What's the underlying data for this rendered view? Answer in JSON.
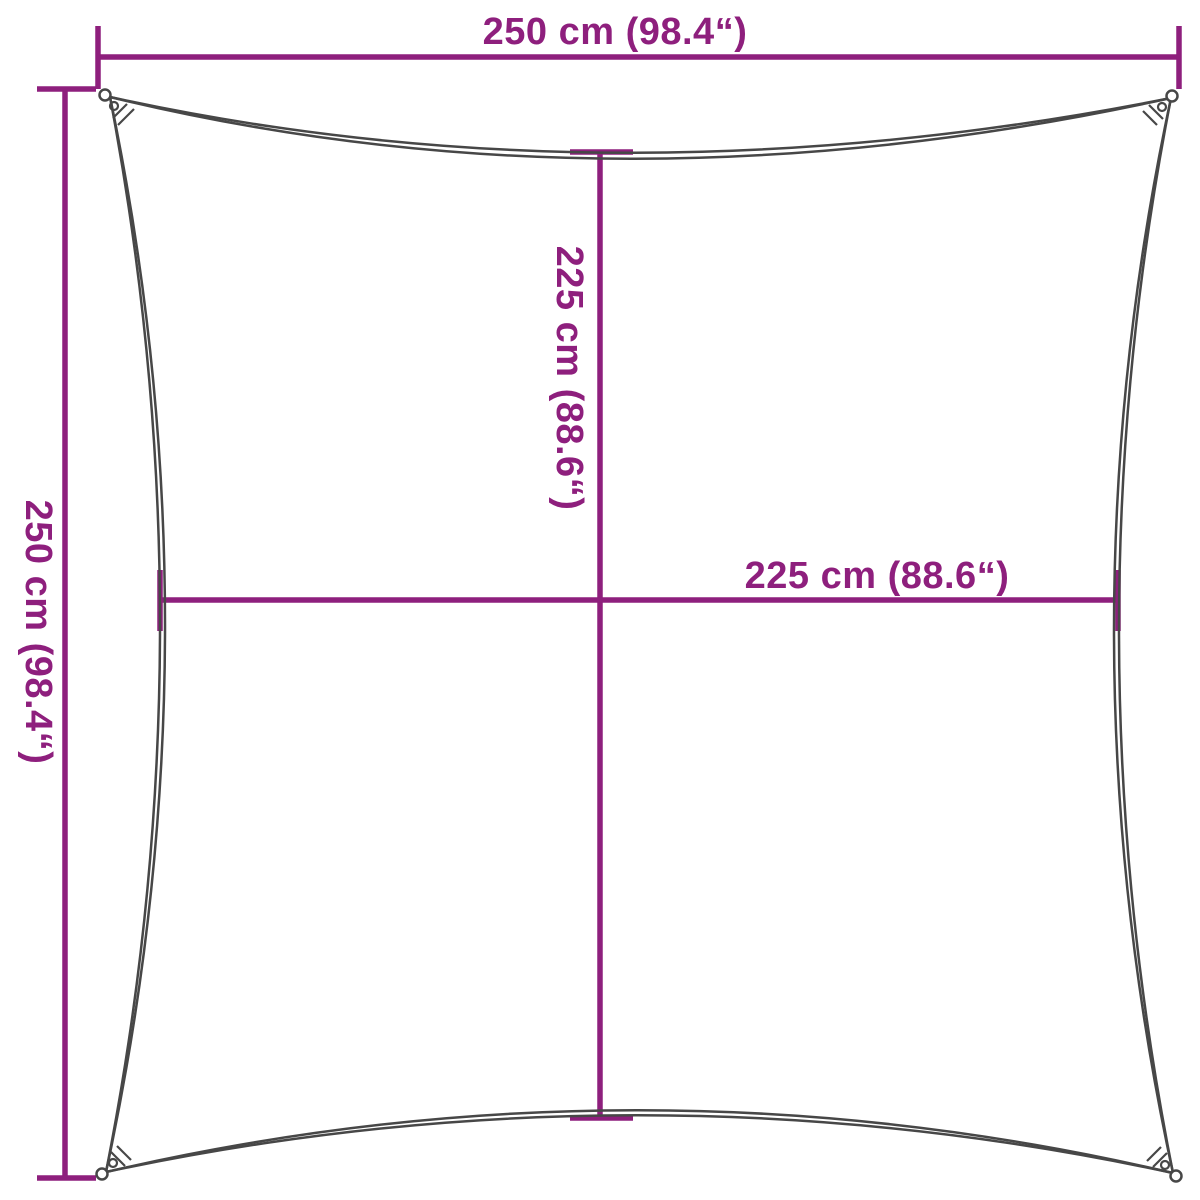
{
  "colors": {
    "dimension": "#8E1F7D",
    "sail_outline": "#474747",
    "background": "#FFFFFF"
  },
  "diagram": {
    "dimensions": {
      "overall_width": {
        "label": "250 cm (98.4“)",
        "cm": 250,
        "inches": 98.4
      },
      "overall_height": {
        "label": "250 cm (98.4“)",
        "cm": 250,
        "inches": 98.4
      },
      "inner_height": {
        "label": "225 cm (88.6“)",
        "cm": 225,
        "inches": 88.6
      },
      "inner_width": {
        "label": "225 cm (88.6“)",
        "cm": 225,
        "inches": 88.6
      }
    }
  }
}
